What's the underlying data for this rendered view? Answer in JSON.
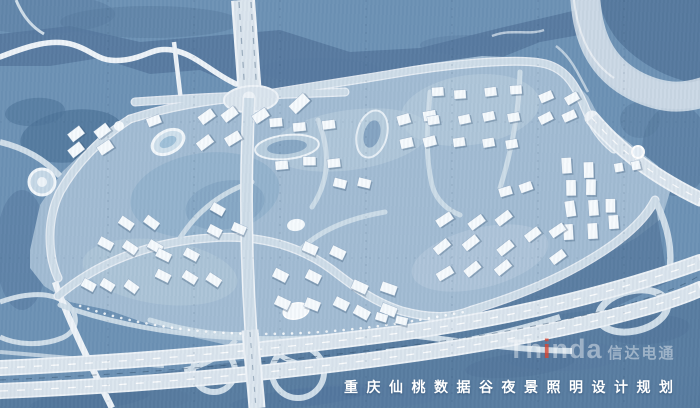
{
  "map": {
    "caption": "重庆仙桃数据谷夜景照明设计规划",
    "watermark": {
      "latin_prefix": "Th",
      "latin_i": "i",
      "latin_suffix": "nda",
      "cjk": "信达电通"
    }
  },
  "colors": {
    "base": "#6d92b5",
    "terrain_dark": "#56799e",
    "terrain_darker": "#4f749a",
    "site": "#a2bcd3",
    "park": "#8fafca",
    "park_dark": "#7fa0bf",
    "block_light": "#bccfdf",
    "road": "#cfdde9",
    "road_casing": "#eef3f8",
    "highway": "#dbe5ee",
    "river_band": "#cbd8e5",
    "building": "#f6fafd",
    "building_shadow": "rgba(45,75,105,0.30)",
    "caption_text": "#ffffff",
    "watermark_white": "rgba(255,255,255,0.42)",
    "watermark_red": "rgba(214,70,50,0.80)"
  }
}
